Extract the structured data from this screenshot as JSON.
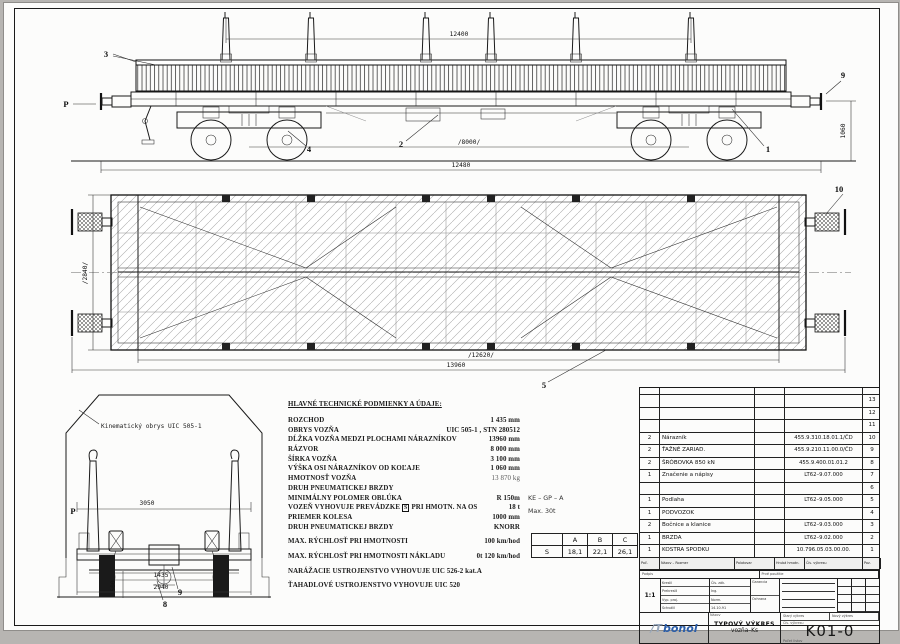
{
  "sheet": {
    "number_label": "Čís. výkresu",
    "drawing_number": "K01-0"
  },
  "side_view": {
    "dim_top": "12400",
    "dim_wheelbase": "/8000/",
    "dim_overall": "12480",
    "dim_buffer_height": "1060",
    "callout_1": "1",
    "callout_2": "2",
    "callout_3": "3",
    "callout_4": "4",
    "callout_9": "9",
    "marker_p": "P"
  },
  "plan_view": {
    "dim_width": "/2840/",
    "dim_frame": "/12620/",
    "dim_over_buffers": "13960",
    "callout_5": "5",
    "callout_10": "10"
  },
  "end_view": {
    "gauge_label": "Kinematický obrys UIC 505-1",
    "marker_p": "P",
    "dim_width_top": "3050",
    "dim_500": "500",
    "dim_gauge": "1435",
    "dim_width": "2940",
    "callout_8": "8",
    "callout_9": "9"
  },
  "specs": {
    "title": "HLAVNÉ TECHNICKÉ PODMIENKY A ÚDAJE:",
    "rows": [
      {
        "label": "ROZCHOD",
        "value": "1 435 mm"
      },
      {
        "label": "OBRYS VOZŇA",
        "value": "UIC 505-1 , STN 280512"
      },
      {
        "label": "DĹŽKA VOZŇA MEDZI PLOCHAMI NÁRAZNÍKOV",
        "value": "13960 mm"
      },
      {
        "label": "RÁZVOR",
        "value": "8 000 mm"
      },
      {
        "label": "ŠÍRKA VOZŇA",
        "value": "3 100 mm"
      },
      {
        "label": "VÝŠKA OSI NÁRAZNÍKOV OD KOĽAJE",
        "value": "1 060 mm"
      },
      {
        "label": "HMOTNOSŤ VOZŇA",
        "value": "13 870 kg"
      },
      {
        "label": "DRUH PNEUMATICKEJ BRZDY",
        "value": ""
      },
      {
        "label": "MINIMÁLNY POLOMER OBLÚKA",
        "value": "R 150m"
      },
      {
        "label": "VOZEŇ VYHOVUJE PREVÁDZKE",
        "boxed": "S",
        "label2": "PRI HMOTN. NA OS",
        "value": "18 t"
      },
      {
        "label": "PRIEMER KOLESA",
        "value": "1000 mm"
      },
      {
        "label": "DRUH PNEUMATICKEJ BRZDY",
        "value": "KNORR"
      },
      {
        "label": "MAX. RÝCHLOSŤ PRI HMOTNOSTI",
        "value": "100 km/hod"
      },
      {
        "label": "MAX. RÝCHLOSŤ PRI HMOTNOSTI NÁKLADU",
        "value": "0t  120 km/hod"
      },
      {
        "label": "NARÁŽACIE USTROJENSTVO VYHOVUJE UIC 526-2 kat.A",
        "value": ""
      },
      {
        "label": "ŤAHADLOVÉ USTROJENSTVO VYHOVUJE UIC 520",
        "value": ""
      }
    ]
  },
  "brake_note": {
    "line1": "KE – GP – A",
    "line2": "Max. 30t"
  },
  "abc_table": {
    "headers": [
      "",
      "A",
      "B",
      "C"
    ],
    "row": [
      "S",
      "18,1",
      "22,1",
      "26,1"
    ]
  },
  "parts_list": {
    "rows": [
      {
        "qty": "",
        "name": "",
        "dwg": "",
        "pos": "13"
      },
      {
        "qty": "",
        "name": "",
        "dwg": "",
        "pos": "12"
      },
      {
        "qty": "",
        "name": "",
        "dwg": "",
        "pos": "11"
      },
      {
        "qty": "2",
        "name": "Nárazník",
        "dwg": "455.9.310.18.01.1/ČD",
        "pos": "10"
      },
      {
        "qty": "2",
        "name": "ŤAŽNÉ ZARIAD.",
        "dwg": "455.9.210.11.00.0/ČD",
        "pos": "9"
      },
      {
        "qty": "2",
        "name": "ŠRÓBOVKA 850 kN",
        "dwg": "455.9.400.01.01.2",
        "pos": "8"
      },
      {
        "qty": "1",
        "name": "Značenie a nápisy",
        "dwg": "LT62–9.07.000",
        "pos": "7"
      },
      {
        "qty": "",
        "name": "",
        "dwg": "",
        "pos": "6"
      },
      {
        "qty": "1",
        "name": "Podlaha",
        "dwg": "LT62–9.05.000",
        "pos": "5"
      },
      {
        "qty": "1",
        "name": "PODVOZOK",
        "dwg": "",
        "pos": "4"
      },
      {
        "qty": "2",
        "name": "Bočnice a klanice",
        "dwg": "LT62–9.03.000",
        "pos": "3"
      },
      {
        "qty": "1",
        "name": "BRZDA",
        "dwg": "LT62–9.02.000",
        "pos": "2"
      },
      {
        "qty": "1",
        "name": "KOSTRA SPODKU",
        "dwg": "10.796.05.03.00.00.",
        "pos": "1"
      }
    ],
    "footer": [
      "Poč. kusov",
      "Názov – Rozmer",
      "Polotovar",
      "Hrubá hmotn.",
      "Čís. výkresu",
      "Poz."
    ]
  },
  "title_block": {
    "strip_left": "Podpis",
    "strip_right": "Prvé použitie",
    "scale": "1:1",
    "rows_left": [
      "Kreslil",
      "Prekreslil",
      "Vyp. proj.",
      "Schválil"
    ],
    "rows_mid": [
      "Čís. zák.",
      "Ing.",
      "Norm.",
      "14.10.91"
    ],
    "cell_a": "Garancia",
    "cell_b": "Ochrana",
    "name_label": "Názov",
    "title1": "TYPOVÝ VÝKRES",
    "title2": "vozňa–Ks",
    "old_label": "Starý výkres",
    "new_label": "Nový výkres",
    "sheets_label": "Počet listov",
    "logo_mark": "/T",
    "logo_text": "bonol"
  }
}
